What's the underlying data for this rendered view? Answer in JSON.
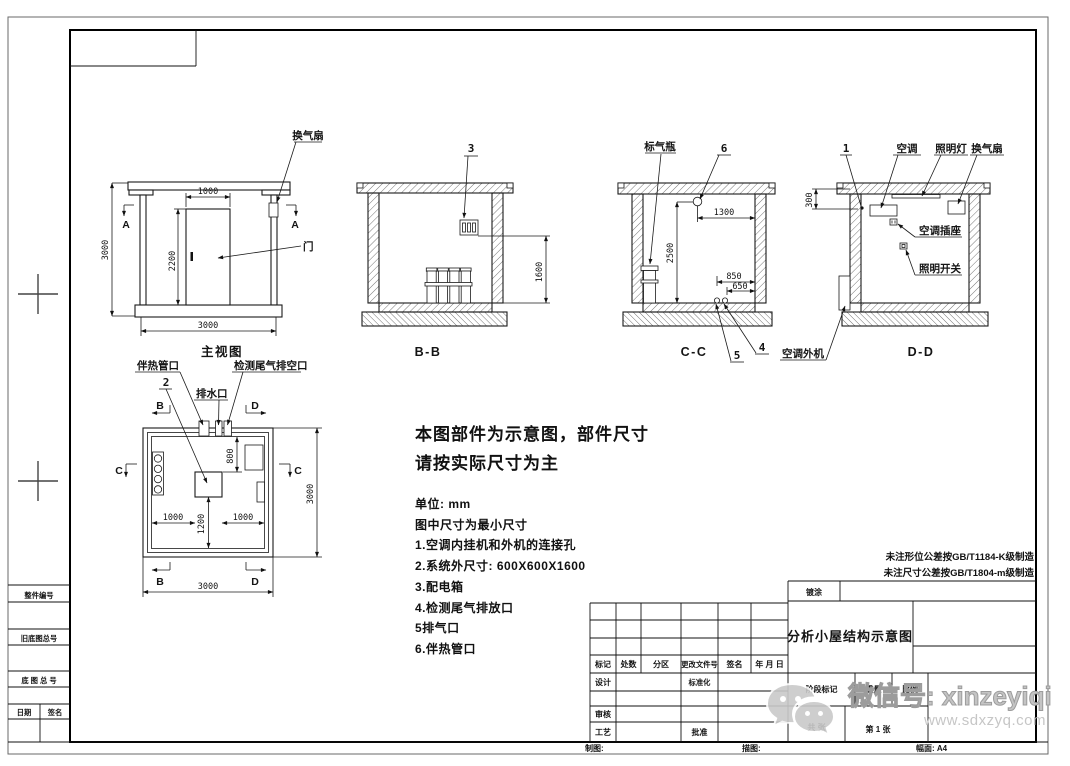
{
  "views": {
    "front": {
      "title": "主视图",
      "label_fan": "换气扇",
      "label_door": "门",
      "dim_door_w": "1000",
      "dim_door_h": "2200",
      "dim_h": "3000",
      "dim_w": "3000",
      "mark_a": "A"
    },
    "section_bb": {
      "title": "B-B",
      "callout_3": "3",
      "dim_1600": "1600"
    },
    "section_cc": {
      "title": "C-C",
      "label_cylinder": "标气瓶",
      "callout_6": "6",
      "callout_4": "4",
      "callout_5": "5",
      "dim_1300": "1300",
      "dim_2500": "2500",
      "dim_850": "850",
      "dim_650": "650"
    },
    "section_dd": {
      "title": "D-D",
      "callout_1": "1",
      "label_ac": "空调",
      "label_lamp": "照明灯",
      "label_fan": "换气扇",
      "label_ac_socket": "空调插座",
      "label_light_switch": "照明开关",
      "label_ac_outdoor": "空调外机",
      "dim_300": "300"
    },
    "plan": {
      "label_heat_pipe": "伴热管口",
      "label_drain": "排水口",
      "label_exhaust_vent": "检测尾气排空口",
      "callout_2": "2",
      "mark_b": "B",
      "mark_c": "C",
      "mark_d": "D",
      "dim_800": "800",
      "dim_1000_left": "1000",
      "dim_1200": "1200",
      "dim_1000_right": "1000",
      "dim_width": "3000",
      "dim_height": "3000"
    }
  },
  "notes": {
    "headline_1": "本图部件为示意图，部件尺寸",
    "headline_2": "请按实际尺寸为主",
    "unit": "单位: mm",
    "min_dim": "图中尺寸为最小尺寸",
    "item_1": "1.空调内挂机和外机的连接孔",
    "item_2": "2.系统外尺寸: 600X600X1600",
    "item_3": "3.配电箱",
    "item_4": "4.检测尾气排放口",
    "item_5": "5排气口",
    "item_6": "6.伴热管口"
  },
  "tolerance_notes": {
    "line_1": "未注形位公差按GB/T1184-K级制造",
    "line_2": "未注尺寸公差按GB/T1804-m级制造"
  },
  "title_block": {
    "coating": "镀涂",
    "drawing_title": "分析小屋结构示意图",
    "rev_headers": {
      "mark": "标记",
      "count": "处数",
      "zone": "分区",
      "change_doc_no": "更改文件号",
      "signature": "签名",
      "date": "年 月 日"
    },
    "roles": {
      "design": "设计",
      "standardization": "标准化",
      "review": "审核",
      "process": "工艺",
      "approve": "批准"
    },
    "stage_mark": "阶段标记",
    "weight": "重量",
    "scale": "比例",
    "sheet_total": "共 张",
    "sheet_no": "第 1 张",
    "draft_label": "制图:",
    "trace_label": "描图:",
    "format_label": "幅面: A4"
  },
  "side_column": {
    "row_1": "整件编号",
    "row_2": "旧底图总号",
    "row_3": "底 图 总 号",
    "date": "日期",
    "signature": "签名"
  },
  "watermark": {
    "wechat_line": "微信号: xinzeyiqi",
    "website": "www.sdxzyq.com"
  }
}
